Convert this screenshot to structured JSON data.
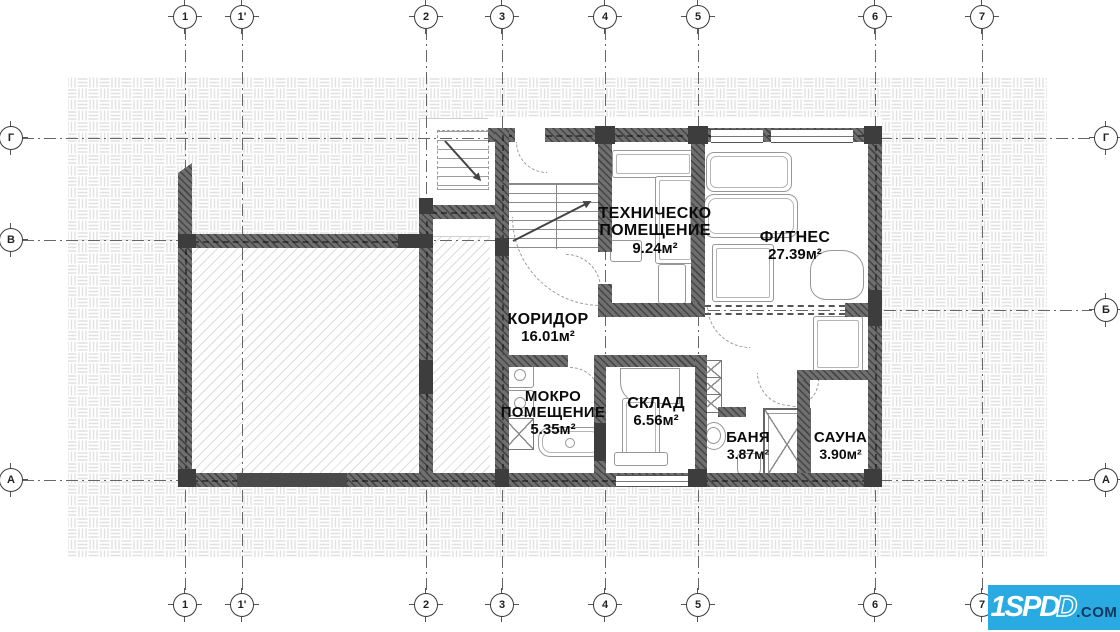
{
  "title": "Basement floor plan",
  "axes": {
    "top": [
      {
        "label": "1"
      },
      {
        "label": "1'"
      },
      {
        "label": "2"
      },
      {
        "label": "3"
      },
      {
        "label": "4"
      },
      {
        "label": "5"
      },
      {
        "label": "6"
      },
      {
        "label": "7"
      }
    ],
    "bottom": [
      {
        "label": "1"
      },
      {
        "label": "1'"
      },
      {
        "label": "2"
      },
      {
        "label": "3"
      },
      {
        "label": "4"
      },
      {
        "label": "5"
      },
      {
        "label": "6"
      },
      {
        "label": "7"
      }
    ],
    "left": [
      {
        "label": "Г"
      },
      {
        "label": "В"
      },
      {
        "label": "А"
      }
    ],
    "right": [
      {
        "label": "Г"
      },
      {
        "label": "Б"
      },
      {
        "label": "А"
      }
    ]
  },
  "rooms": {
    "tech": {
      "name": "ТЕХНИЧЕСКО ПОМЕЩЕНИЕ",
      "area": "9.24м²"
    },
    "fitness": {
      "name": "ФИТНЕС",
      "area": "27.39м²"
    },
    "corridor": {
      "name": "КОРИДОР",
      "area": "16.01м²"
    },
    "wet": {
      "name": "МОКРО ПОМЕЩЕНИЕ",
      "area": "5.35м²"
    },
    "storage": {
      "name": "СКЛАД",
      "area": "6.56м²"
    },
    "bath": {
      "name": "БАНЯ",
      "area": "3.87м²"
    },
    "sauna": {
      "name": "САУНА",
      "area": "3.90м²"
    }
  },
  "logo": {
    "brand": "1SPD",
    "brand_outline": "D",
    "tld": ".COM",
    "bg": "#29abe2",
    "tld_color": "#16365c"
  },
  "colors": {
    "wall": "#6f6f6f",
    "pier": "#3d3d3d",
    "hatch": "#e0e0e0",
    "grid": "#666666",
    "accent": "#29abe2"
  }
}
